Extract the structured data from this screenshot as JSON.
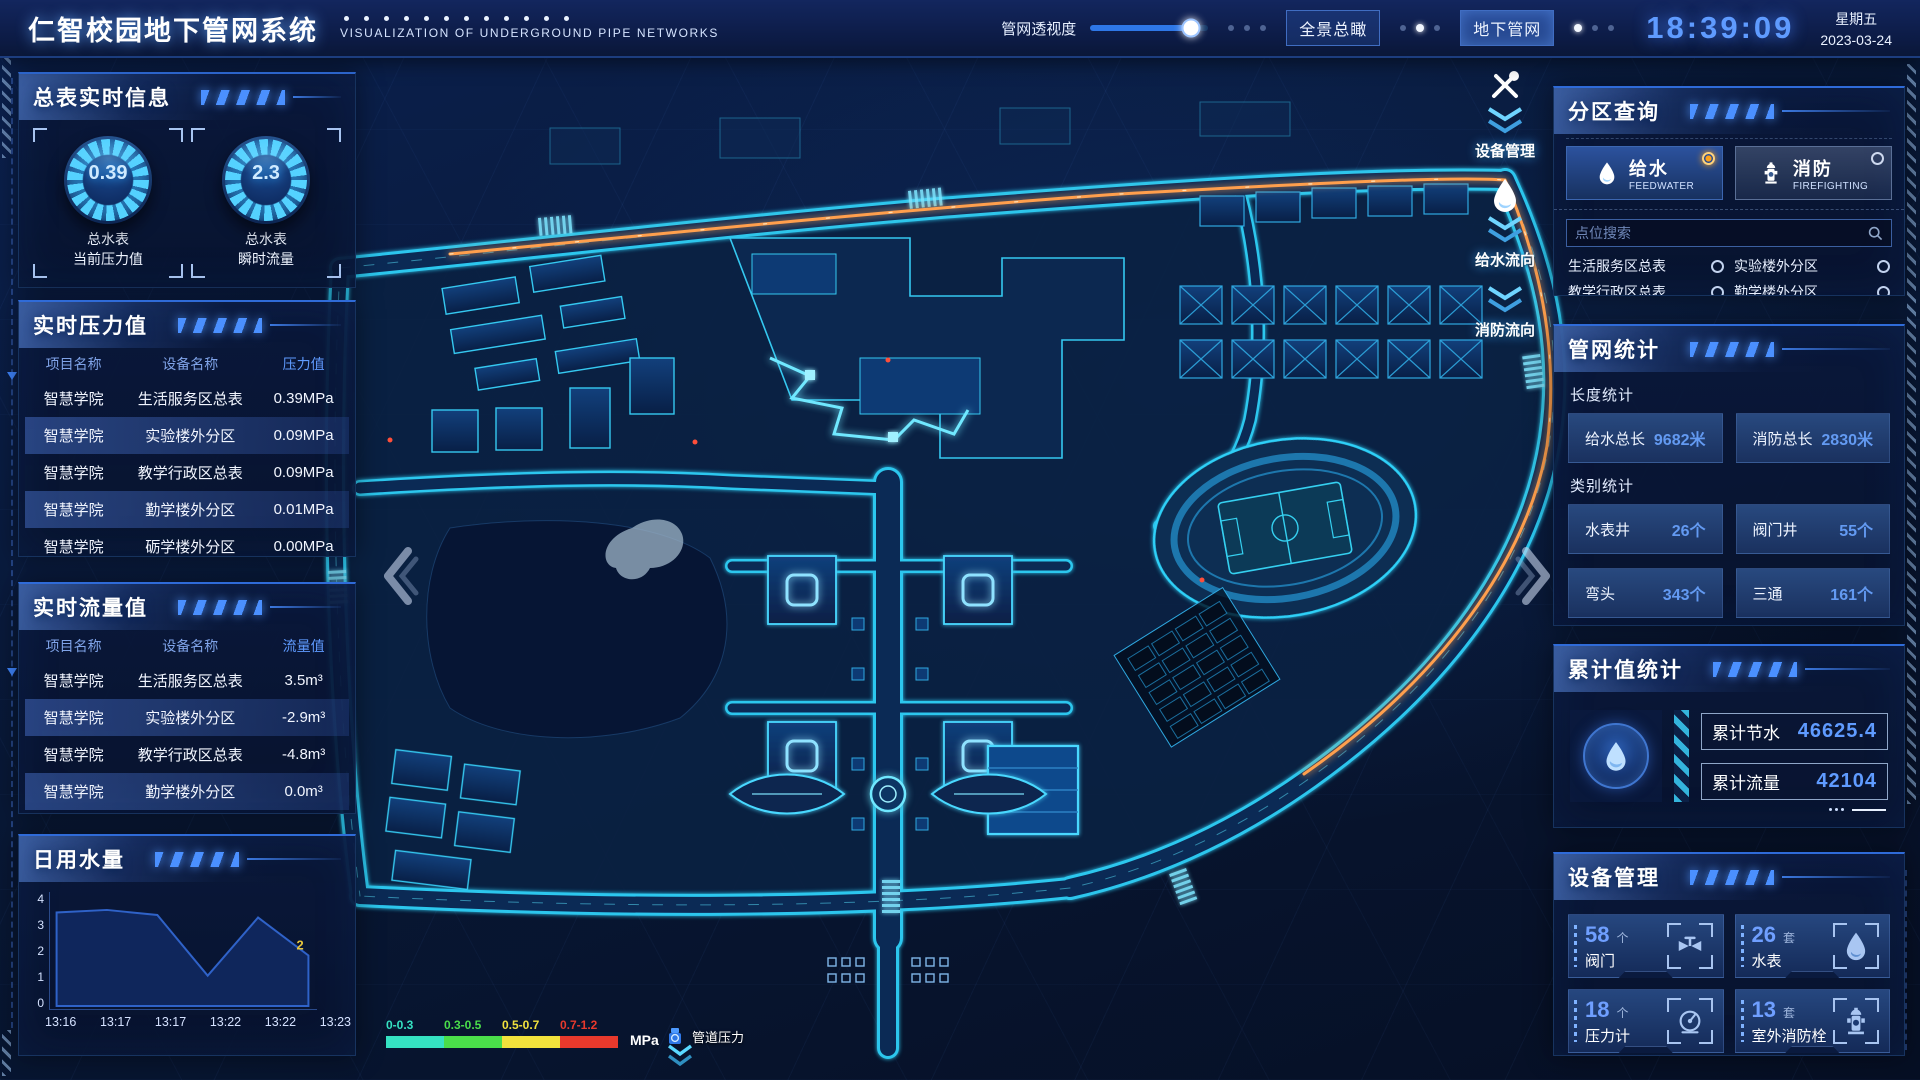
{
  "colors": {
    "accent": "#3f86ff",
    "cyan": "#35d8ff",
    "value_blue": "#5f9bff",
    "pipe_orange": "#ff9f4d",
    "radio_orange": "#ffa21a"
  },
  "header": {
    "title": "仁智校园地下管网系统",
    "subtitle": "VISUALIZATION OF UNDERGROUND PIPE NETWORKS",
    "opacity_label": "管网透视度",
    "slider_percent": 85,
    "btn_overview": "全景总瞰",
    "btn_underground": "地下管网",
    "time": "18:39:09",
    "weekday": "星期五",
    "date": "2023-03-24"
  },
  "left": {
    "realtime_info": {
      "title": "总表实时信息",
      "gauges": [
        {
          "value": "0.39",
          "line1": "总水表",
          "line2": "当前压力值"
        },
        {
          "value": "2.3",
          "line1": "总水表",
          "line2": "瞬时流量"
        }
      ]
    },
    "pressure": {
      "title": "实时压力值",
      "headers": [
        "项目名称",
        "设备名称",
        "压力值"
      ],
      "rows": [
        [
          "智慧学院",
          "生活服务区总表",
          "0.39MPa"
        ],
        [
          "智慧学院",
          "实验楼外分区",
          "0.09MPa"
        ],
        [
          "智慧学院",
          "教学行政区总表",
          "0.09MPa"
        ],
        [
          "智慧学院",
          "勤学楼外分区",
          "0.01MPa"
        ],
        [
          "智慧学院",
          "砺学楼外分区",
          "0.00MPa"
        ]
      ]
    },
    "flow": {
      "title": "实时流量值",
      "headers": [
        "项目名称",
        "设备名称",
        "流量值"
      ],
      "rows": [
        [
          "智慧学院",
          "生活服务区总表",
          "3.5m³"
        ],
        [
          "智慧学院",
          "实验楼外分区",
          "-2.9m³"
        ],
        [
          "智慧学院",
          "教学行政区总表",
          "-4.8m³"
        ],
        [
          "智慧学院",
          "勤学楼外分区",
          "0.0m³"
        ],
        [
          "智慧学院",
          "砺学楼外分区",
          "2.3m³"
        ]
      ]
    },
    "daily": {
      "title": "日用水量"
    }
  },
  "chart_data": {
    "type": "area",
    "title": "日用水量",
    "x": [
      "13:16",
      "13:17",
      "13:17",
      "13:22",
      "13:22",
      "13:23"
    ],
    "values": [
      3.7,
      3.8,
      3.6,
      1.2,
      3.5,
      2.0
    ],
    "ylim": [
      0,
      4
    ],
    "yticks": [
      0,
      1,
      2,
      3,
      4
    ],
    "last_label": "2",
    "line_color": "#2f62c8",
    "fill_color": "rgba(16,40,96,0.92)",
    "label_color": "#e8c63c",
    "legend_position": "none",
    "grid": false
  },
  "map": {
    "toolbar": [
      {
        "icon": "tools-icon",
        "label": "设备管理"
      },
      {
        "icon": "water-drop-icon",
        "label": "给水流向"
      },
      {
        "icon": "hydrant-icon",
        "label": "消防流向"
      }
    ],
    "legend": {
      "ranges": [
        {
          "label": "0-0.3",
          "color": "#35e2c2"
        },
        {
          "label": "0.3-0.5",
          "color": "#4ade4a"
        },
        {
          "label": "0.5-0.7",
          "color": "#f2e23c"
        },
        {
          "label": "0.7-1.2",
          "color": "#e8392c"
        }
      ],
      "unit": "MPa",
      "meter_label": "管道压力"
    }
  },
  "right": {
    "zone_query": {
      "title": "分区查询",
      "tabs": [
        {
          "label": "给水",
          "sub": "FEEDWATER",
          "selected": true
        },
        {
          "label": "消防",
          "sub": "FIREFIGHTING",
          "selected": false
        }
      ],
      "search_placeholder": "点位搜索",
      "items": [
        "生活服务区总表",
        "实验楼外分区",
        "教学行政区总表",
        "勤学楼外分区",
        "砺学楼外分区",
        "宿舍区泵房"
      ]
    },
    "pipe_stats": {
      "title": "管网统计",
      "length_title": "长度统计",
      "length_stats": [
        {
          "label": "给水总长",
          "value": "9682米"
        },
        {
          "label": "消防总长",
          "value": "2830米"
        }
      ],
      "category_title": "类别统计",
      "category_stats": [
        {
          "label": "水表井",
          "value": "26个"
        },
        {
          "label": "阀门井",
          "value": "55个"
        },
        {
          "label": "弯头",
          "value": "343个"
        },
        {
          "label": "三通",
          "value": "161个"
        }
      ]
    },
    "cumulative": {
      "title": "累计值统计",
      "stats": [
        {
          "label": "累计节水",
          "value": "46625.4"
        },
        {
          "label": "累计流量",
          "value": "42104"
        }
      ]
    },
    "devices": {
      "title": "设备管理",
      "cards": [
        {
          "count": "58",
          "unit": "个",
          "label": "阀门",
          "icon": "valve-icon"
        },
        {
          "count": "26",
          "unit": "套",
          "label": "水表",
          "icon": "water-meter-icon"
        },
        {
          "count": "18",
          "unit": "个",
          "label": "压力计",
          "icon": "pressure-gauge-icon"
        },
        {
          "count": "13",
          "unit": "套",
          "label": "室外消防栓",
          "icon": "outdoor-hydrant-icon"
        }
      ]
    }
  }
}
